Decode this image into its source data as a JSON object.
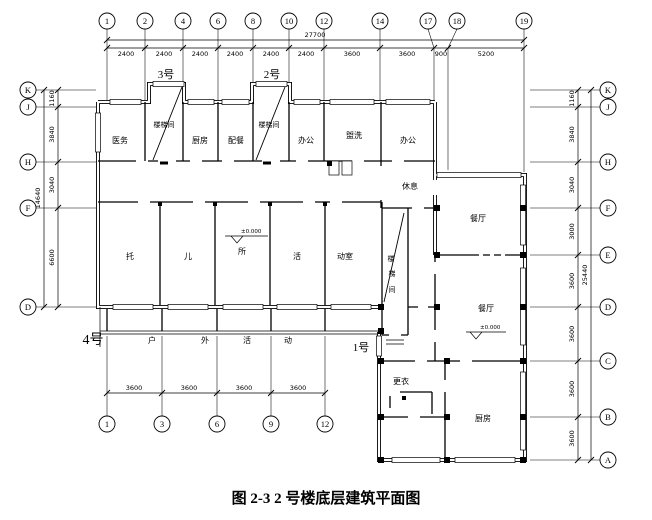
{
  "caption": "图 2-3 2 号楼底层建筑平面图",
  "colors": {
    "line": "#000000",
    "background": "#ffffff"
  },
  "axes": {
    "top": {
      "labels": [
        "1",
        "2",
        "4",
        "6",
        "8",
        "10",
        "12",
        "14",
        "17",
        "18",
        "19"
      ]
    },
    "bottom": {
      "labels": [
        "1",
        "3",
        "6",
        "9",
        "12"
      ]
    },
    "left": {
      "labels": [
        "K",
        "J",
        "H",
        "F",
        "D"
      ]
    },
    "right": {
      "labels": [
        "K",
        "J",
        "H",
        "F",
        "E",
        "D",
        "C",
        "B",
        "A"
      ]
    }
  },
  "dimensions": {
    "top_total": "27700",
    "top": [
      "2400",
      "2400",
      "2400",
      "2400",
      "2400",
      "2400",
      "3600",
      "3600",
      "900",
      "5200"
    ],
    "left_total": "14640",
    "left": [
      "1160",
      "3840",
      "3040",
      "6600"
    ],
    "right_total": "25440",
    "right": [
      "1160",
      "3840",
      "3040",
      "3000",
      "3600",
      "3600",
      "3600",
      "3600"
    ],
    "bottom": [
      "3600",
      "3600",
      "3600",
      "3600"
    ]
  },
  "units": {
    "u3": "3号",
    "u2": "2号",
    "u4": "4号",
    "u1": "1号"
  },
  "rooms": {
    "yiwu": "医务",
    "stair_a": "楼梯间",
    "chufang_top": "厨房",
    "peican": "配餐",
    "stair_b": "楼梯间",
    "bangong_a": "办公",
    "guanxi": "盥洗",
    "bangong_b": "办公",
    "xiuxi": "休息",
    "tuo": "托",
    "er": "儿",
    "suo": "所",
    "huo": "活",
    "dongshi": "动室",
    "stair_c": [
      "楼",
      "梯",
      "间"
    ],
    "canting_a": "餐厅",
    "canting_b": "餐厅",
    "gengyi": "更衣",
    "chufang_br": "厨房"
  },
  "outdoor": [
    "户",
    "外",
    "活",
    "动"
  ],
  "levels": {
    "main": "±0.000",
    "wing": "±0.000"
  }
}
